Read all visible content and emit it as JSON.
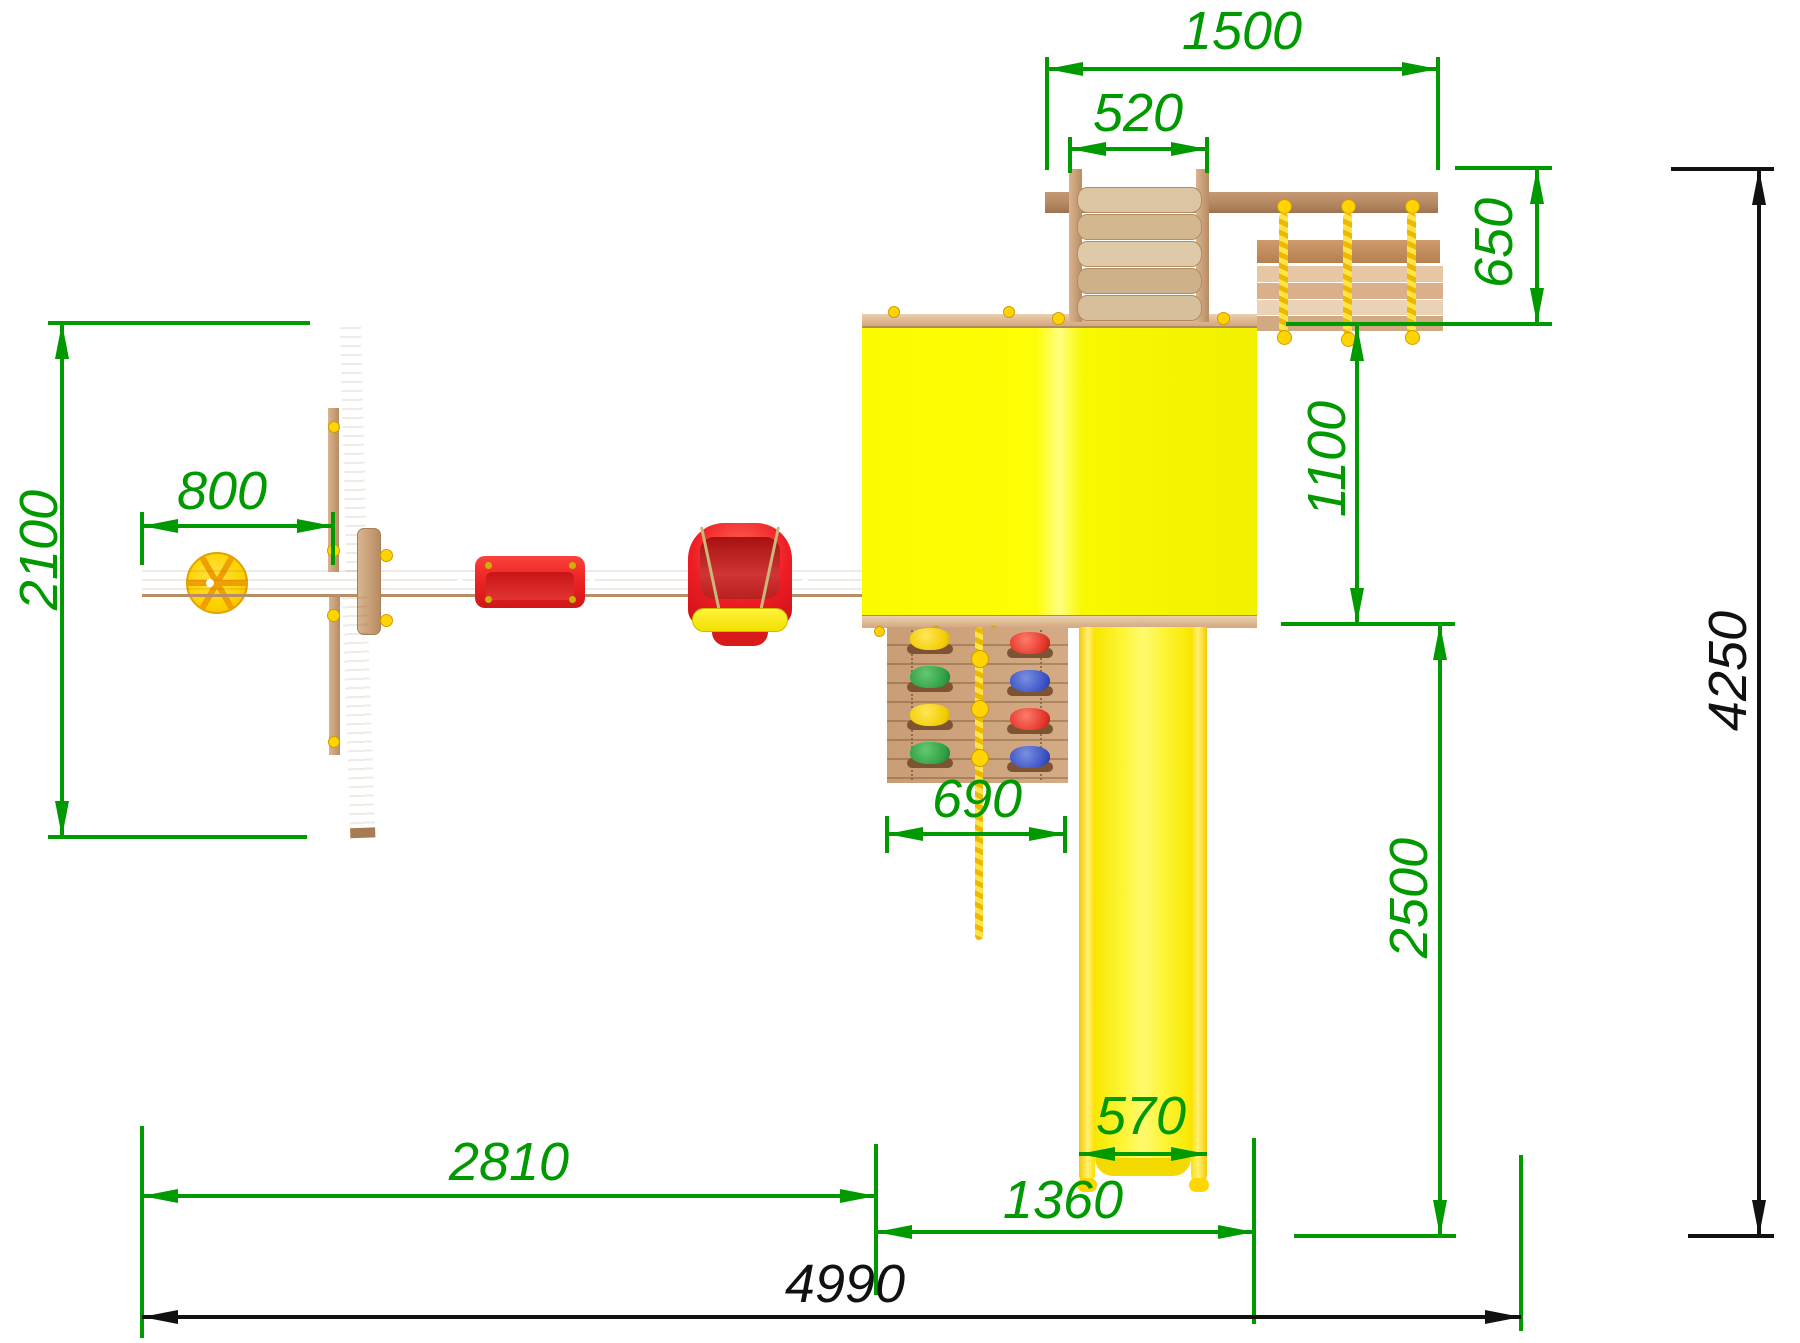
{
  "drawing": {
    "background_color": "#ffffff",
    "dimension_color": "#009900",
    "overall_dimension_color": "#111111",
    "wood_color": "#d3a87f",
    "roof_color": "#fafa00",
    "slide_color": "#fdf400"
  },
  "dims": {
    "d1500": {
      "label": "1500"
    },
    "d520": {
      "label": "520"
    },
    "d650": {
      "label": "650"
    },
    "d1100": {
      "label": "1100"
    },
    "d2100": {
      "label": "2100"
    },
    "d800": {
      "label": "800"
    },
    "d690": {
      "label": "690"
    },
    "d570": {
      "label": "570"
    },
    "d2810": {
      "label": "2810"
    },
    "d1360": {
      "label": "1360"
    },
    "d2500": {
      "label": "2500"
    },
    "d4250": {
      "label": "4250"
    },
    "d4990": {
      "label": "4990"
    }
  }
}
